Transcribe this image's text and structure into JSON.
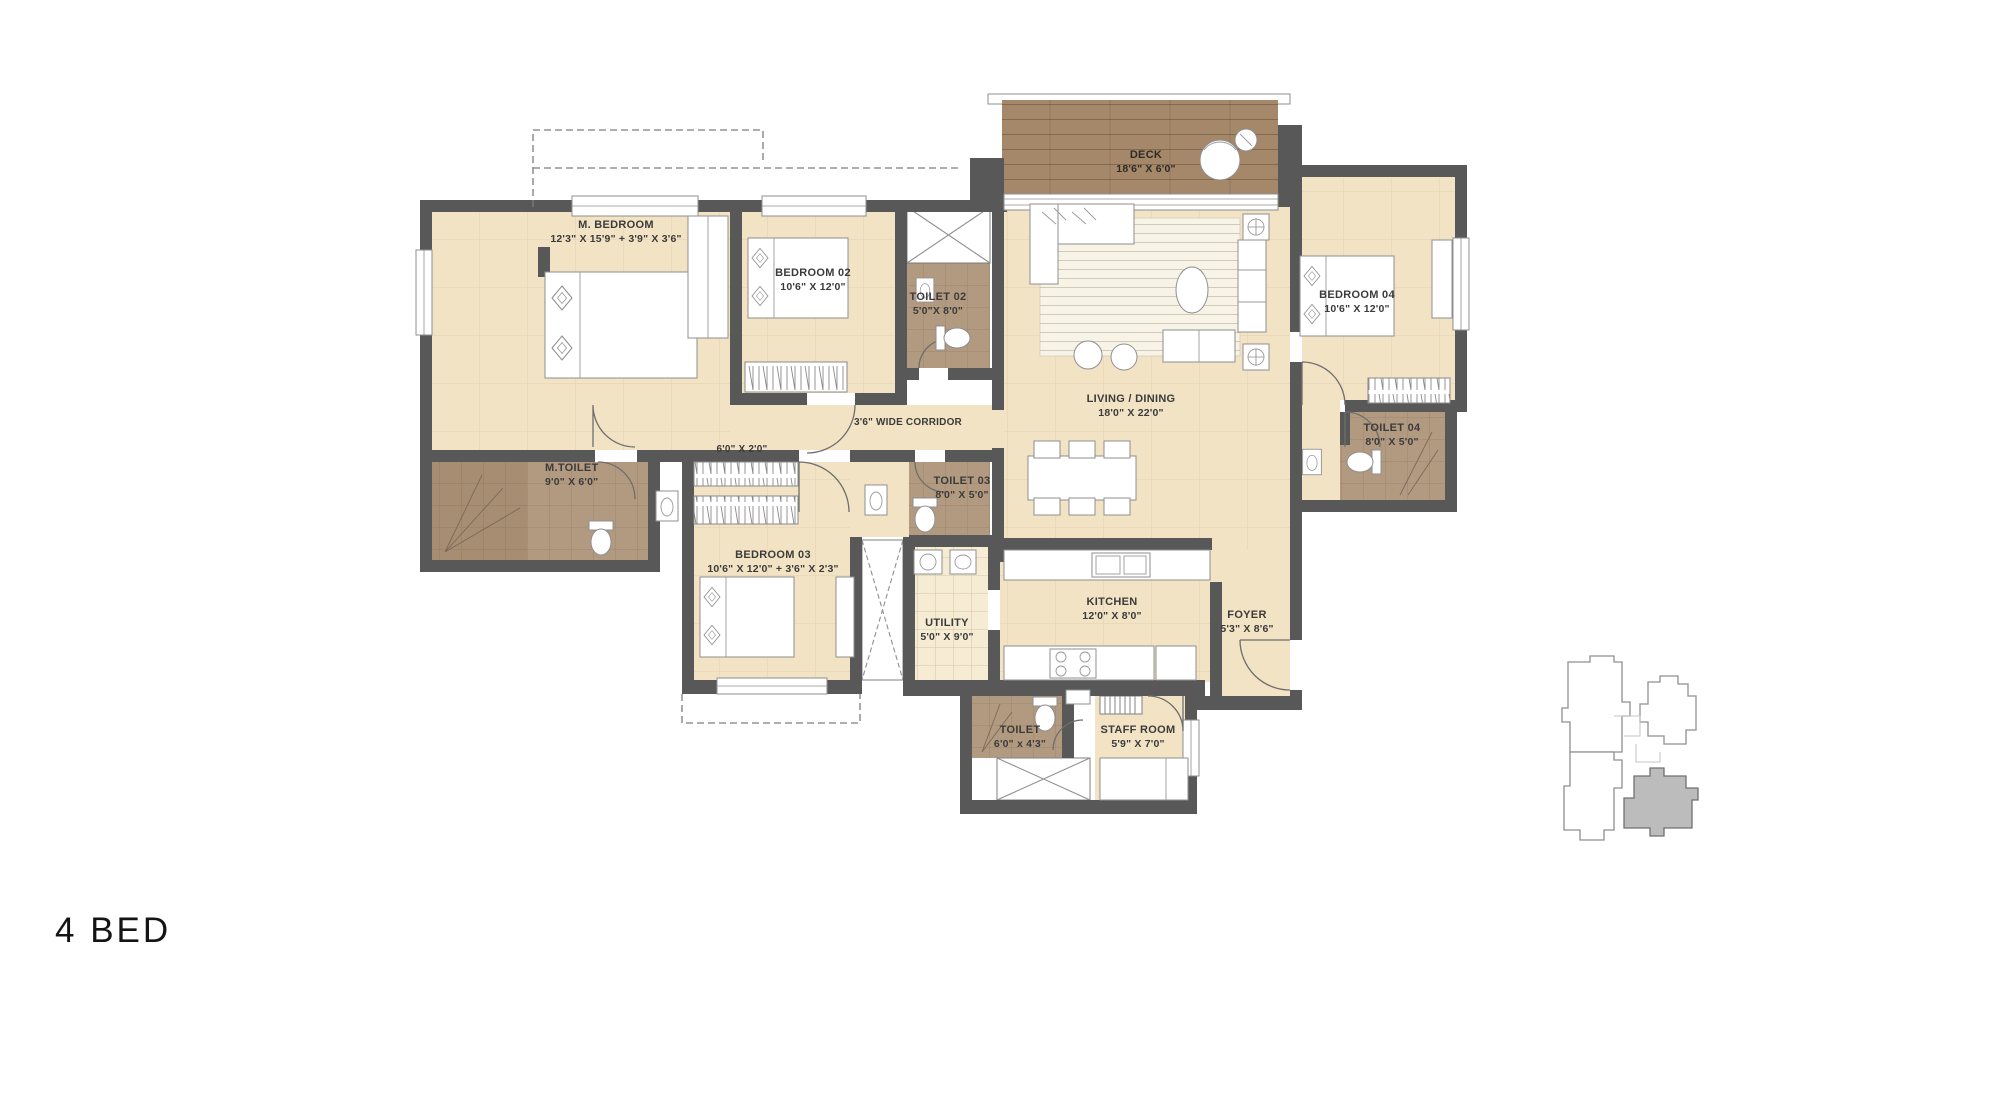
{
  "title": "4 BED",
  "plan": {
    "rooms": {
      "deck": {
        "name": "DECK",
        "dims": "18'6\" X 6'0\""
      },
      "m_bedroom": {
        "name": "M. BEDROOM",
        "dims": "12'3\" X 15'9\"  +  3'9\" X 3'6\""
      },
      "bedroom_02": {
        "name": "BEDROOM 02",
        "dims": "10'6\" X 12'0\""
      },
      "toilet_02": {
        "name": "TOILET 02",
        "dims": "5'0\"X 8'0\""
      },
      "living_dining": {
        "name": "LIVING / DINING",
        "dims": "18'0\" X 22'0\""
      },
      "bedroom_04": {
        "name": "BEDROOM 04",
        "dims": "10'6\" X 12'0\""
      },
      "toilet_04": {
        "name": "TOILET 04",
        "dims": "8'0\" X 5'0\""
      },
      "corridor": {
        "name": "3'6\" WIDE CORRIDOR"
      },
      "corridor_closet": {
        "name": "6'0\" X 2'0\""
      },
      "m_toilet": {
        "name": "M.TOILET",
        "dims": "9'0\" X 6'0\""
      },
      "toilet_03": {
        "name": "TOILET 03",
        "dims": "8'0\" X 5'0\""
      },
      "bedroom_03": {
        "name": "BEDROOM 03",
        "dims": "10'6\" X 12'0\"  +  3'6\" X 2'3\""
      },
      "utility": {
        "name": "UTILITY",
        "dims": "5'0\" X 9'0\""
      },
      "kitchen": {
        "name": "KITCHEN",
        "dims": "12'0\" X 8'0\""
      },
      "foyer": {
        "name": "FOYER",
        "dims": "5'3\" X 8'6\""
      },
      "staff_toilet": {
        "name": "TOILET",
        "dims": "6'0\" x 4'3\""
      },
      "staff_room": {
        "name": "STAFF ROOM",
        "dims": "5'9\" X 7'0\""
      }
    },
    "colors": {
      "wall": "#585858",
      "floor": "#f2e3c5",
      "utility_floor": "#f6ecd4",
      "toilet_tile": "#b29a81",
      "shower_tile": "#a78d72",
      "deck_wood": "#a5876a",
      "rug": "#f8f3e7",
      "keyplan_highlight": "#bcbcbc",
      "label_text": "#3b3b3b"
    }
  }
}
